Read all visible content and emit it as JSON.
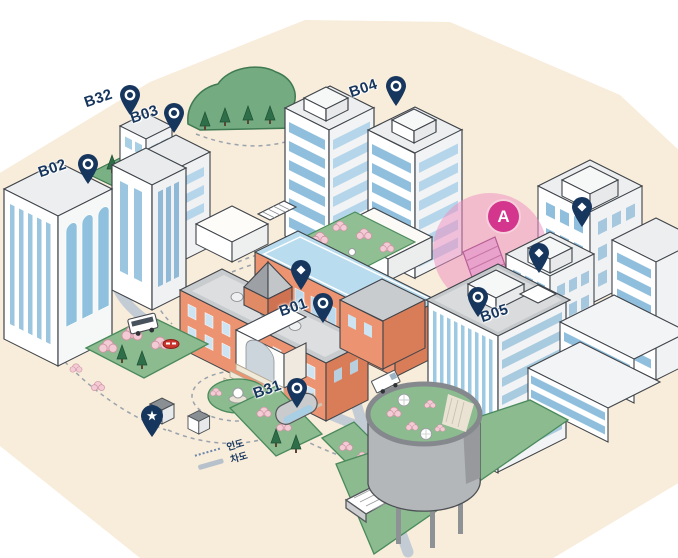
{
  "pins": {
    "b01": {
      "label": "B01"
    },
    "b02": {
      "label": "B02"
    },
    "b03": {
      "label": "B03"
    },
    "b04": {
      "label": "B04"
    },
    "b05": {
      "label": "B05"
    },
    "b31": {
      "label": "B31"
    },
    "b32": {
      "label": "B32"
    }
  },
  "marker_a": {
    "label": "A"
  },
  "legend": {
    "pedestrian_label": "인도",
    "road_label": "차도"
  },
  "colors": {
    "pin_navy": "#17365e",
    "marker_magenta": "#d3368c",
    "highlight_pink": "#ee8fc2",
    "road_gray_blue": "#c3ccd5",
    "window_blue": "#a9cfe5",
    "brick_orange": "#ec9471",
    "ground_cream": "#f8ecda",
    "garden_green": "#8bbb8f",
    "hill_green": "#74ab81"
  }
}
